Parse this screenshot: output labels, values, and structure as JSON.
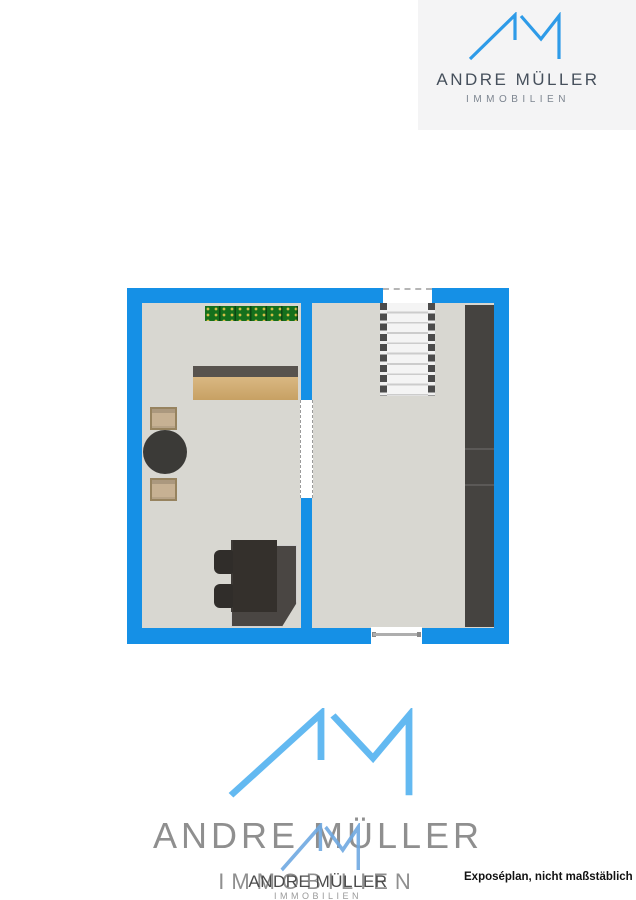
{
  "header": {
    "brand_name": "ANDRE MÜLLER",
    "brand_subtitle": "IMMOBILIEN"
  },
  "watermark": {
    "brand_name": "ANDRE MÜLLER",
    "brand_subtitle": "IMMOBILIEN",
    "overlay_name": "ANDRE MÜLLER",
    "overlay_subtitle": "IMMOBILIEN"
  },
  "footer": {
    "note": "Exposéplan, nicht maßstäblich"
  },
  "floorplan": {
    "rooms": [
      {
        "name": "left-room",
        "contents": [
          "doormat",
          "sideboard",
          "two-armchairs",
          "round-table",
          "dining-table-with-chairs"
        ]
      },
      {
        "name": "right-room",
        "contents": [
          "staircase",
          "wardrobe",
          "window"
        ]
      }
    ],
    "openings": [
      "door-opening-in-divider-wall",
      "stair-opening-top-wall",
      "window-bottom-wall"
    ]
  },
  "colors": {
    "wall": "#1590e6",
    "floor": "#d8d7d1",
    "accent": "#2e9be8",
    "logo-box": "#f4f4f5",
    "brand-dark": "#46505c",
    "brand-gray": "#7d8590",
    "wm-blue": "#63b9f1",
    "wm-blue-small": "#6fa9e2",
    "wm-gray": "#8f8f8f",
    "wm-dark": "#4c4c4c",
    "wm-light": "#9a9a9a",
    "wood": "#d8ae6c",
    "wood-edge": "#58534e",
    "mat": "#15701c",
    "mat-dot": "#d8c04a",
    "tan": "#c7b193",
    "tan-border": "#97835f",
    "round-table": "#3b3a37",
    "dining-shadow": "#4a4643",
    "dining-top": "#34302c",
    "dining-chair": "#302d2a",
    "wardrobe": "#454340",
    "stair-tread": "#f4f4f4",
    "stair-line": "#cccccc",
    "stair-stringer": "#4b4b4b",
    "window-bar": "#aeaeae",
    "note": "#111111"
  }
}
